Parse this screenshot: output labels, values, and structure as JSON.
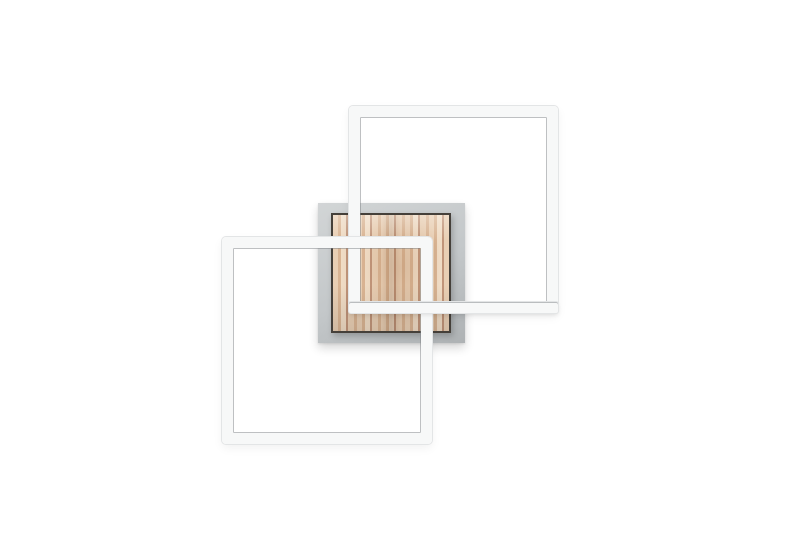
{
  "image_type": "product-photo",
  "description": "Modern LED wall or ceiling lamp: two interlocking white square light frames mounted on a square brushed-grey plate with a light pine wood panel, on a plain white background. No visible text.",
  "visible_text": [],
  "palette": {
    "bg": "#ffffff",
    "frame-fill": "#f7f8f8",
    "frame-edge": "#e3e5e6",
    "frame-hairline": "rgba(125,130,134,0.50)",
    "plate-light": "#d2d5d6",
    "plate-mid": "#c3c7c9",
    "plate-dark": "#aeb2b4",
    "wood-light": "#e9cfb4",
    "wood-light2": "#f0dcc5",
    "wood-mid": "#d9b493",
    "wood-dark": "#c1957a",
    "wood-border": "#45403a"
  },
  "scene": {
    "canvas": {
      "w": 800,
      "h": 533
    },
    "bar_thickness": 11,
    "rects": {
      "backplate": {
        "x": 318,
        "y": 203,
        "w": 147,
        "h": 140
      },
      "wood-panel": {
        "x": 331,
        "y": 213,
        "w": 120,
        "h": 120
      },
      "frame-upper": {
        "x": 349,
        "y": 106,
        "w": 209,
        "h": 207
      },
      "frame-lower": {
        "x": 222,
        "y": 237,
        "w": 210,
        "h": 207
      },
      "frame-upper-bottom-bar": {
        "x": 349,
        "y": 302,
        "w": 209,
        "h": 11
      }
    }
  }
}
